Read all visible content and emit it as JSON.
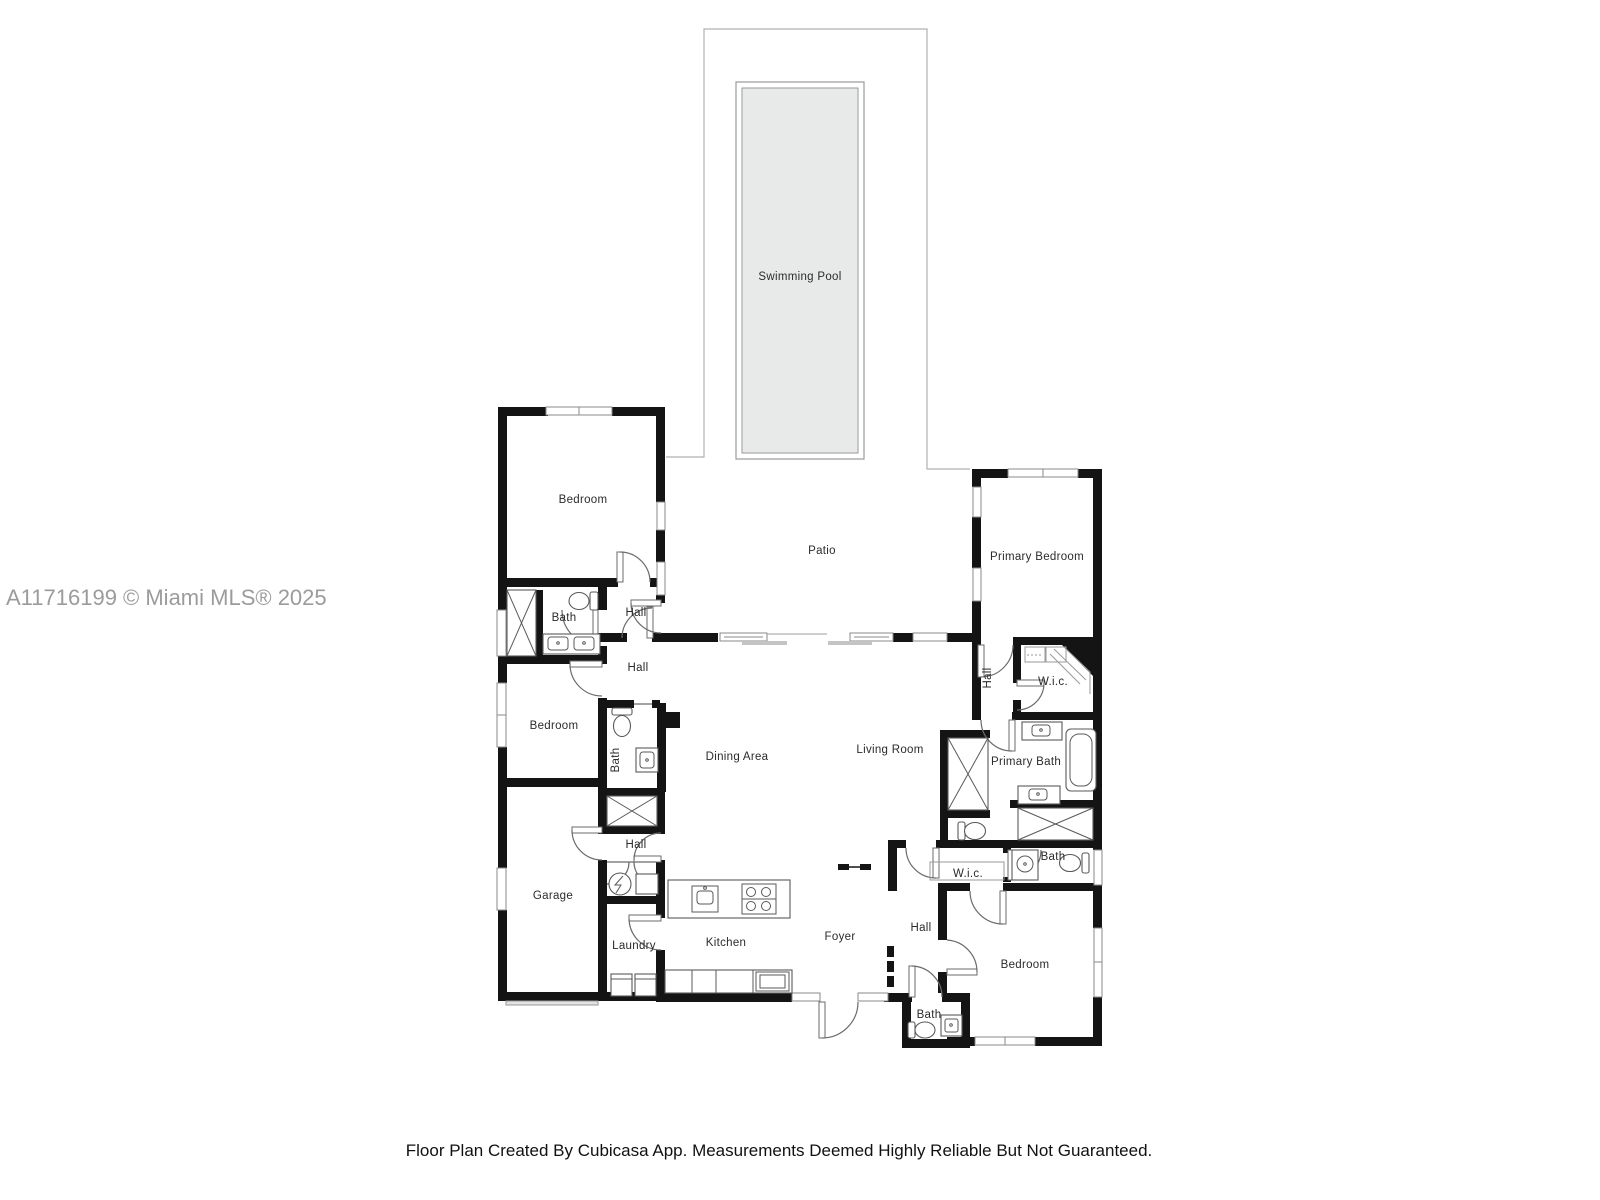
{
  "plan": {
    "watermark": "A11716199 © Miami MLS® 2025",
    "footer": "Floor Plan Created By Cubicasa App. Measurements Deemed Highly Reliable But Not Guaranteed."
  },
  "rooms": {
    "swimming_pool": "Swimming Pool",
    "patio": "Patio",
    "bedroom_top_left": "Bedroom",
    "bath_top_left": "Bath",
    "hall_upper": "Hall",
    "hall_mid": "Hall",
    "bedroom_mid_left": "Bedroom",
    "bath_mid": "Bath",
    "dining_area": "Dining Area",
    "living_room": "Living Room",
    "primary_bedroom": "Primary Bedroom",
    "hall_primary": "Hall",
    "wic_primary": "W.i.c.",
    "primary_bath": "Primary Bath",
    "garage": "Garage",
    "hall_garage": "Hall",
    "laundry": "Laundry",
    "kitchen": "Kitchen",
    "foyer": "Foyer",
    "hall_rear": "Hall",
    "wic_rear": "W.i.c.",
    "bath_rear": "Bath",
    "bedroom_bottom_right": "Bedroom",
    "bath_bottom": "Bath"
  },
  "colors": {
    "wall": "#141414",
    "pool_fill": "#e8e9e9",
    "outline": "#b0b0b0",
    "label": "#2b2b2b",
    "watermark": "#9b9b9b",
    "footer": "#111111"
  }
}
